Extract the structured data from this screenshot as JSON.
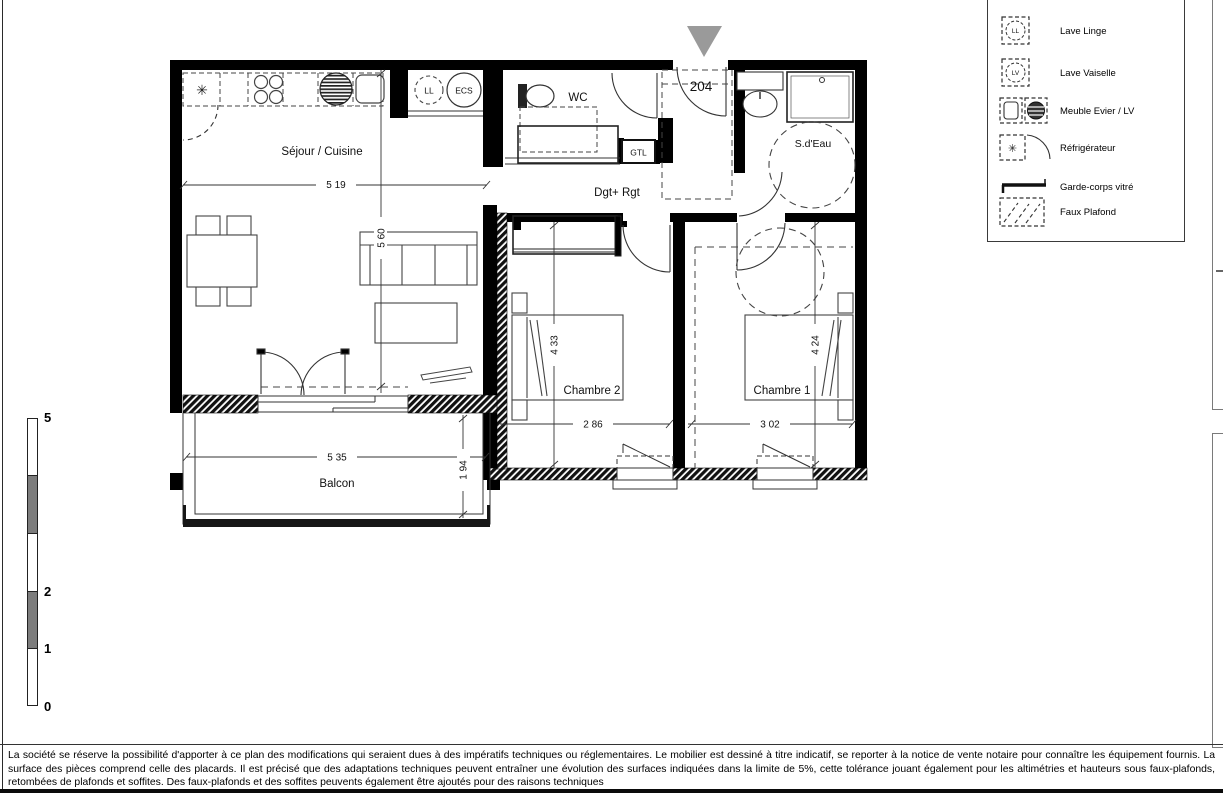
{
  "plan": {
    "unit_number": "204",
    "rooms": {
      "sejour_cuisine": "Séjour / Cuisine",
      "wc": "WC",
      "degagement": "Dgt+ Rgt",
      "salle_deau": "S.d'Eau",
      "chambre2": "Chambre 2",
      "chambre1": "Chambre 1",
      "balcon": "Balcon"
    },
    "labels": {
      "gtl": "GTL",
      "lave_linge": "LL",
      "ecs": "ECS",
      "refrigerator_glyph": "✳"
    },
    "dims": {
      "sejour_width": "5 19",
      "sejour_height": "5 60",
      "chambre2_height": "4 33",
      "chambre2_width": "2 86",
      "chambre1_height": "4 24",
      "chambre1_width": "3 02",
      "balcon_width": "5 35",
      "balcon_depth": "1 94"
    }
  },
  "legend": {
    "items": [
      {
        "label": "Lave Linge",
        "tag": "LL"
      },
      {
        "label": "Lave Vaiselle",
        "tag": "LV"
      },
      {
        "label": "Meuble Evier / LV",
        "tag": ""
      },
      {
        "label": "Réfrigérateur",
        "tag": "✳"
      },
      {
        "label": "Garde-corps vitré",
        "tag": ""
      },
      {
        "label": "Faux Plafond",
        "tag": ""
      }
    ]
  },
  "scale_bar": {
    "labels": [
      "5",
      "2",
      "1",
      "0"
    ]
  },
  "disclaimer": "La société se réserve la possibilité d'apporter à ce plan des modifications qui seraient dues à des impératifs techniques ou réglementaires. Le mobilier est dessiné à titre indicatif, se reporter à la notice de vente notaire pour connaître les équipement fournis. La surface des pièces comprend celle des placards. Il est précisé que des adaptations techniques peuvent entraîner une évolution des surfaces indiquées dans la limite de 5%, cette tolérance jouant également pour les altimétries et hauteurs sous faux-plafonds, retombées de plafonds et soffites. Des faux-plafonds et des soffites peuvents également être ajoutés pour des raisons techniques",
  "colors": {
    "triangle_gray": "#9a9a9a",
    "wall_black": "#000000"
  }
}
